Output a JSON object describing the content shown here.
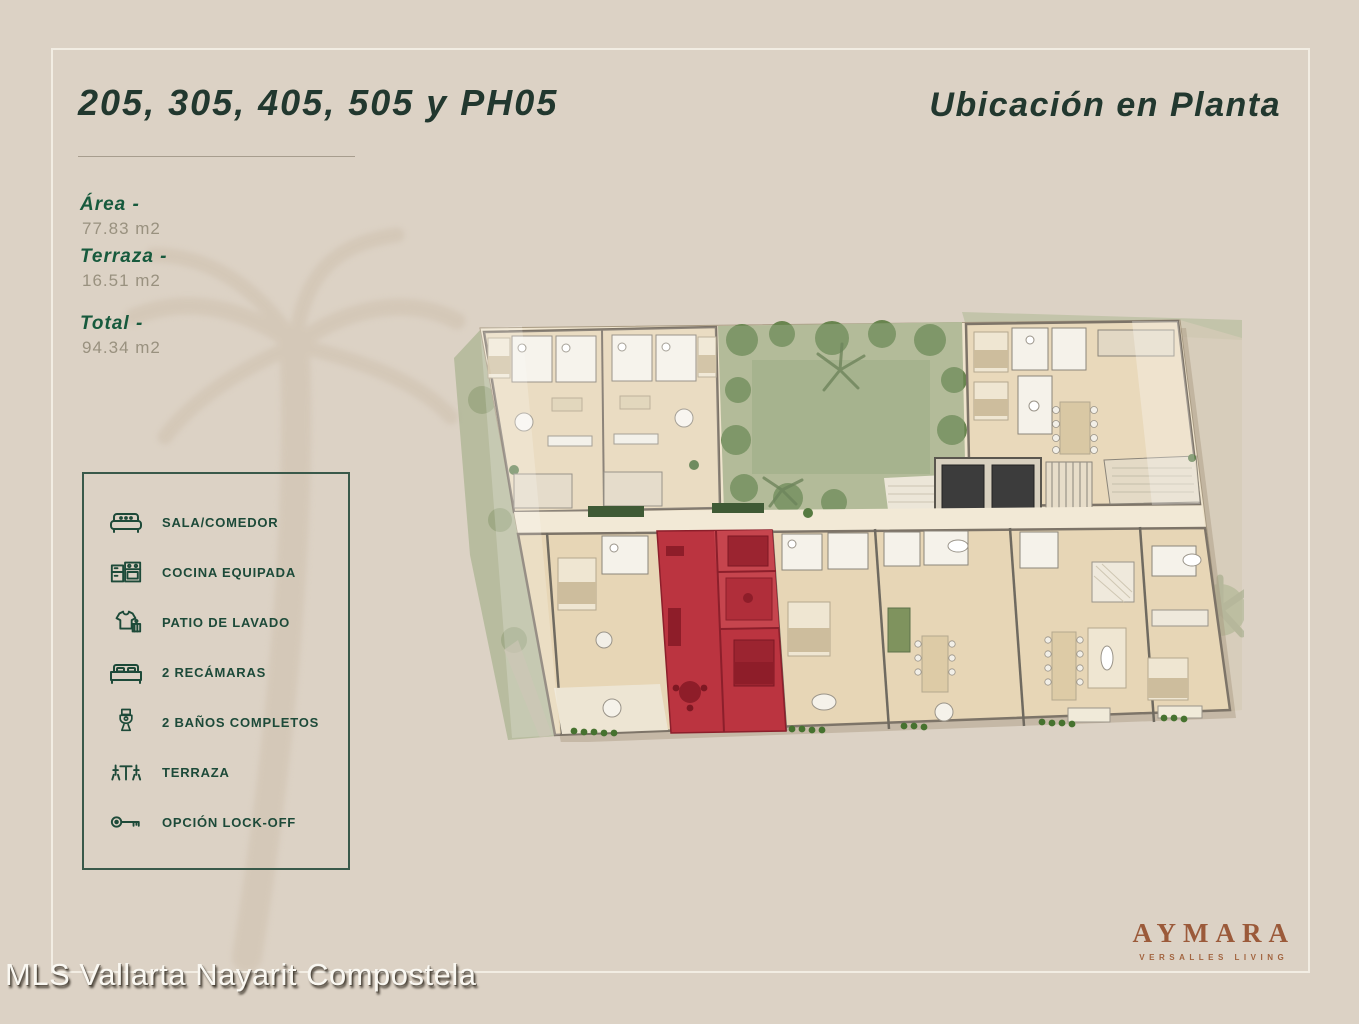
{
  "header": {
    "title": "205, 305, 405, 505 y PH05",
    "subtitle": "Ubicación en Planta"
  },
  "measurements": {
    "items": [
      {
        "label": "Área -",
        "value": "77.83 m2"
      },
      {
        "label": "Terraza -",
        "value": "16.51 m2"
      },
      {
        "label": "Total -",
        "value": "94.34 m2"
      }
    ]
  },
  "legend": {
    "items": [
      {
        "icon": "sofa-icon",
        "label": "SALA/COMEDOR"
      },
      {
        "icon": "kitchen-icon",
        "label": "COCINA EQUIPADA"
      },
      {
        "icon": "laundry-icon",
        "label": "PATIO DE LAVADO"
      },
      {
        "icon": "bed-icon",
        "label": "2 RECÁMARAS"
      },
      {
        "icon": "toilet-icon",
        "label": "2 BAÑOS COMPLETOS"
      },
      {
        "icon": "terrace-icon",
        "label": "TERRAZA"
      },
      {
        "icon": "key-icon",
        "label": "OPCIÓN LOCK-OFF"
      }
    ]
  },
  "floor_plan": {
    "highlight_color": "#bb3440"
  },
  "brand": {
    "name": "AYMARA",
    "tagline": "VERSALLES LIVING"
  },
  "watermark": {
    "text": "MLS Vallarta Nayarit Compostela"
  },
  "colors": {
    "background": "#dcd2c5",
    "accent_green": "#175a3d",
    "heading_green": "#22382f",
    "brand_brown": "#9b5a3a",
    "highlight_red": "#bb3440"
  }
}
